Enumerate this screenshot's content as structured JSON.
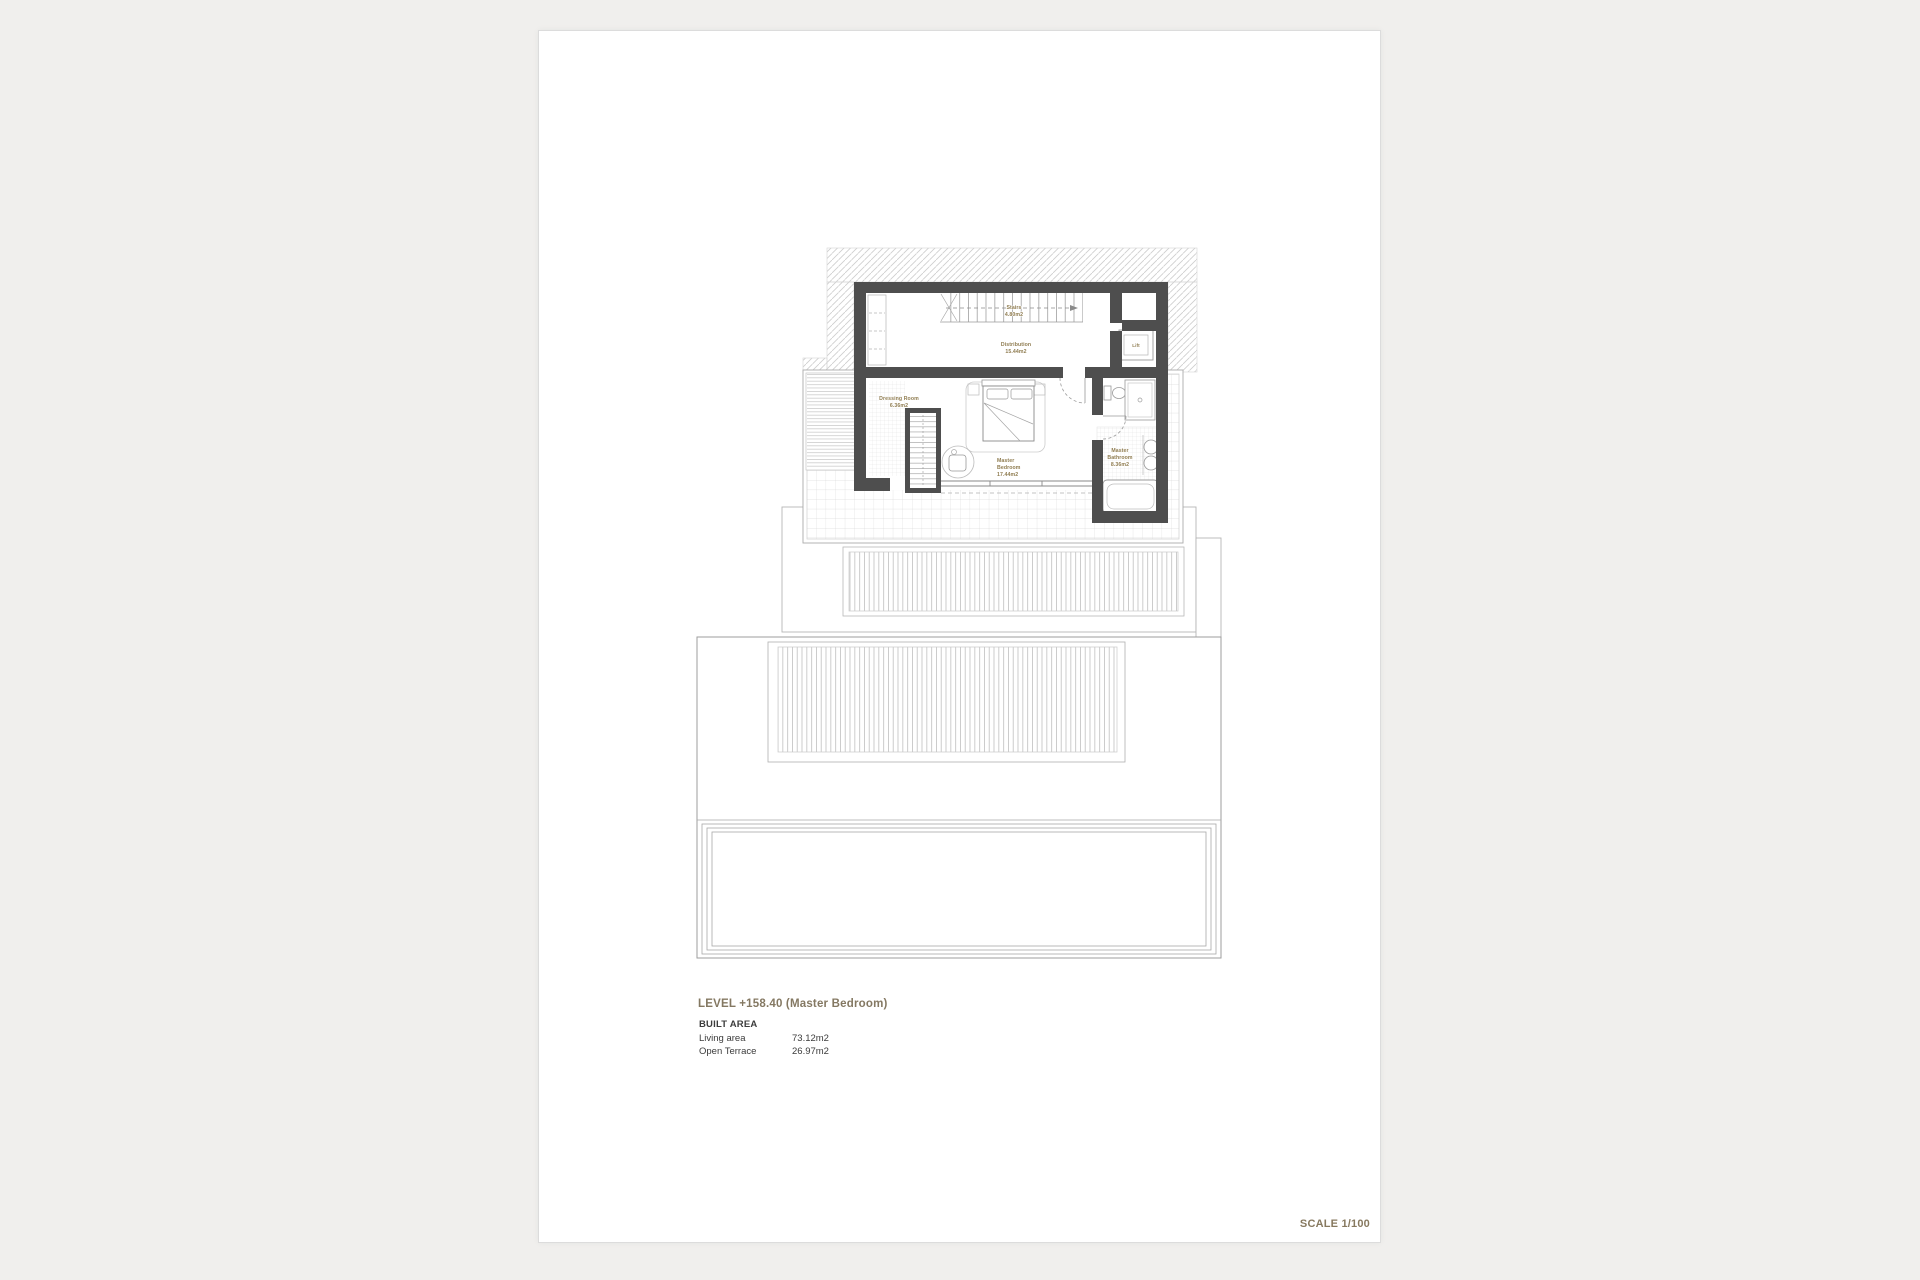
{
  "document": {
    "level_title": "LEVEL +158.40 (Master Bedroom)",
    "built_area_heading": "BUILT AREA",
    "areas": [
      {
        "label": "Living area",
        "value": "73.12m2"
      },
      {
        "label": "Open Terrace",
        "value": "26.97m2"
      }
    ],
    "scale_label": "SCALE 1/100"
  },
  "plan": {
    "rooms": {
      "stairs": {
        "name": "Stairs",
        "area": "4.80m2"
      },
      "distribution": {
        "name": "Distribution",
        "area": "15.44m2"
      },
      "dressing_room": {
        "name": "Dressing Room",
        "area": "6.36m2"
      },
      "master_bedroom": {
        "line1": "Master",
        "line2": "Bedroom",
        "area": "17.44m2"
      },
      "master_bathroom": {
        "line1": "Master",
        "line2": "Bathroom",
        "area": "8.36m2"
      },
      "lift": {
        "name": "Lift"
      }
    },
    "colors": {
      "wall": "#4e4e4e",
      "room_label": "#8f7c50",
      "title": "#847862"
    }
  }
}
